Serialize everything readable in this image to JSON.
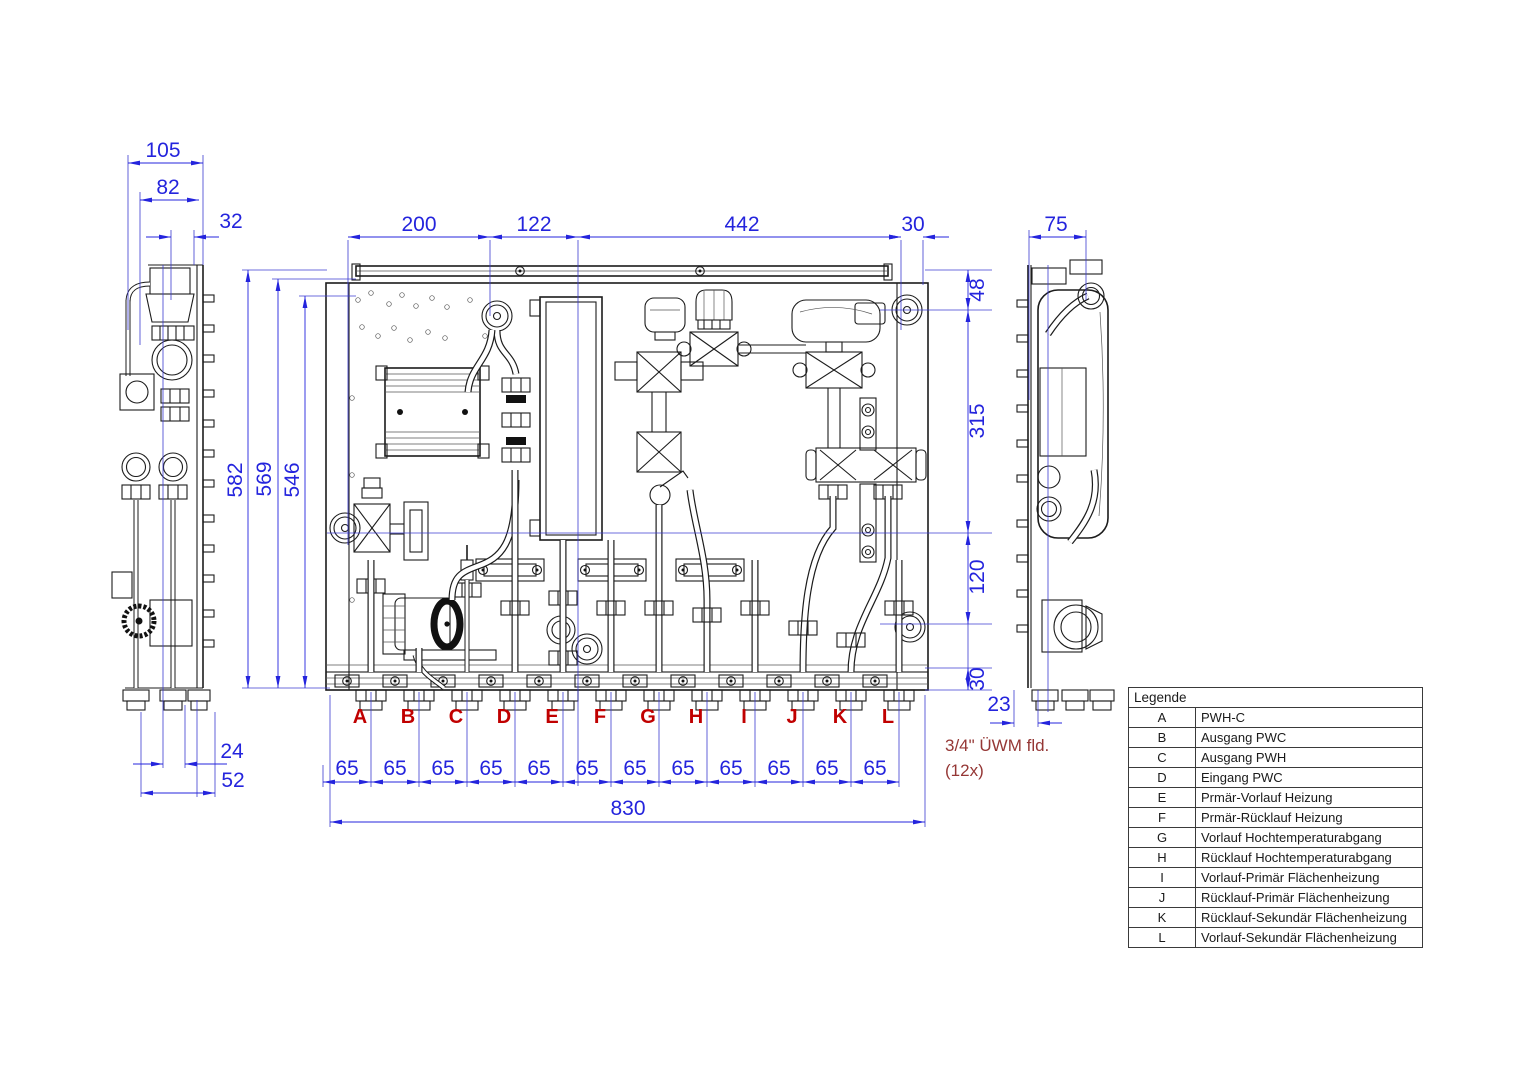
{
  "drawing": {
    "note": {
      "line1": "3/4\" ÜWM fld.",
      "line2": "(12x)"
    },
    "legend": {
      "title": "Legende",
      "rows": [
        {
          "key": "A",
          "label": "PWH-C"
        },
        {
          "key": "B",
          "label": "Ausgang PWC"
        },
        {
          "key": "C",
          "label": "Ausgang PWH"
        },
        {
          "key": "D",
          "label": "Eingang PWC"
        },
        {
          "key": "E",
          "label": "Prmär-Vorlauf Heizung"
        },
        {
          "key": "F",
          "label": "Prmär-Rücklauf Heizung"
        },
        {
          "key": "G",
          "label": "Vorlauf Hochtemperaturabgang"
        },
        {
          "key": "H",
          "label": "Rücklauf Hochtemperaturabgang"
        },
        {
          "key": "I",
          "label": "Vorlauf-Primär Flächenheizung"
        },
        {
          "key": "J",
          "label": "Rücklauf-Primär Flächenheizung"
        },
        {
          "key": "K",
          "label": "Rücklauf-Sekundär Flächenheizung"
        },
        {
          "key": "L",
          "label": "Vorlauf-Sekundär Flächenheizung"
        }
      ]
    },
    "left_view": {
      "dims": {
        "d105": "105",
        "d82": "82",
        "d32": "32",
        "d24": "24",
        "d52": "52"
      }
    },
    "front_view": {
      "dims_top": {
        "d200": "200",
        "d122": "122",
        "d442": "442",
        "d30": "30"
      },
      "dims_left": {
        "d582": "582",
        "d569": "569",
        "d546": "546"
      },
      "dims_right": {
        "d48": "48",
        "d315": "315",
        "d120": "120",
        "d30": "30"
      },
      "dims_bottom": {
        "spacing": [
          "65",
          "65",
          "65",
          "65",
          "65",
          "65",
          "65",
          "65",
          "65",
          "65",
          "65",
          "65"
        ],
        "total": "830"
      },
      "connections": [
        "A",
        "B",
        "C",
        "D",
        "E",
        "F",
        "G",
        "H",
        "I",
        "J",
        "K",
        "L"
      ]
    },
    "right_view": {
      "dims": {
        "d75": "75",
        "d23": "23"
      }
    },
    "colors": {
      "dimension": "#2424dd",
      "connection_label": "#c00000",
      "note": "#953735",
      "line": "#1c1c1c"
    }
  }
}
